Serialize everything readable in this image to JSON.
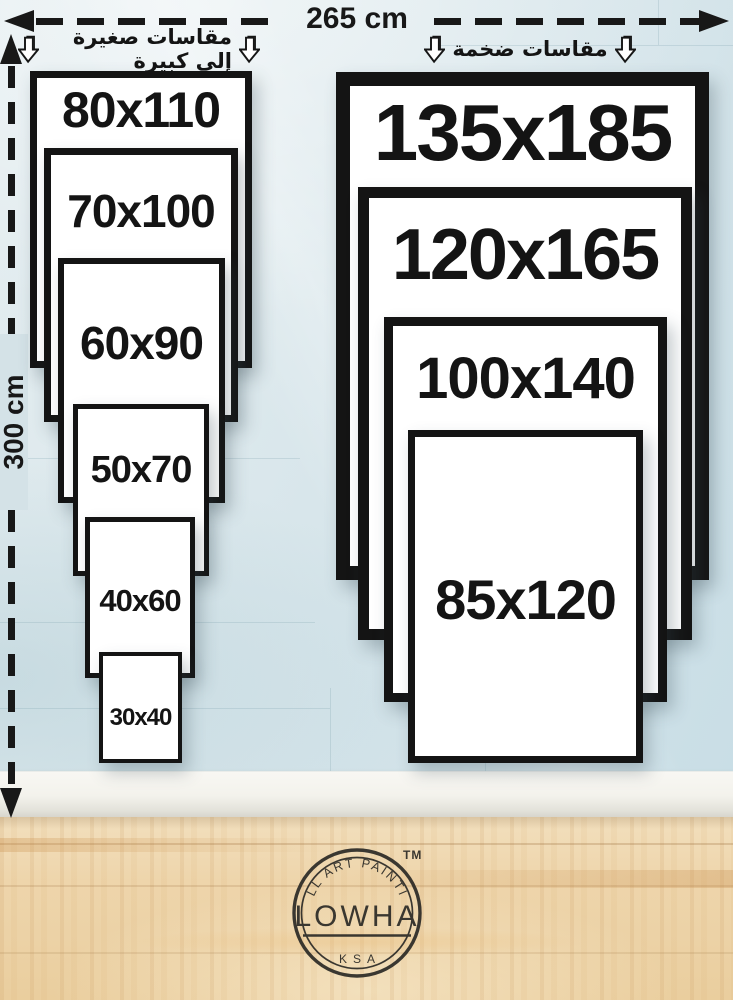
{
  "scale": {
    "horizontal_label": "265 cm",
    "vertical_label": "300 cm"
  },
  "groups": {
    "small_to_large_label": "مقاسات صغيرة إلى كبيرة",
    "huge_sizes_label": "مقاسات ضخمة"
  },
  "left_stack": {
    "sizes": [
      "80x110",
      "70x100",
      "60x90",
      "50x70",
      "40x60",
      "30x40"
    ]
  },
  "right_stack": {
    "sizes": [
      "135x185",
      "120x165",
      "100x140",
      "85x120"
    ]
  },
  "brand": {
    "trademark": "TM",
    "ring_text": "WALL ART PAINTING",
    "name": "LOWHA",
    "origin": "KSA"
  },
  "colors": {
    "ink": "#181818",
    "wall": "#d8e5ea",
    "baseboard": "#f2f1ec",
    "floor": "#eed3a9",
    "frame_fill": "#ffffff"
  }
}
